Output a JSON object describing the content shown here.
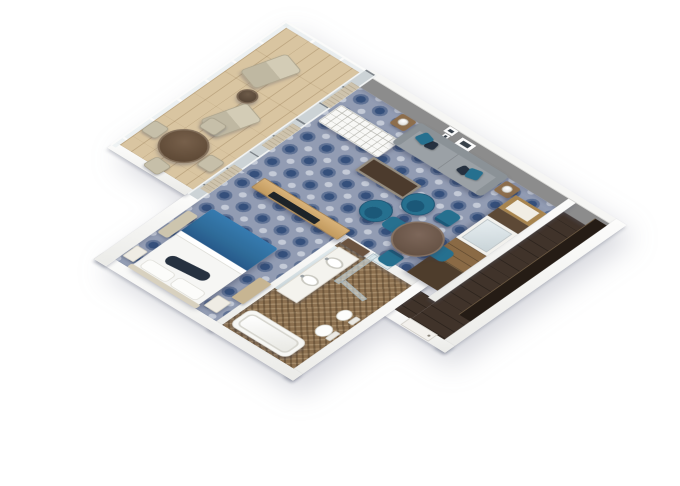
{
  "scene": {
    "type": "3d-floorplan-render",
    "view": "isometric-top-down",
    "colors": {
      "background": "#ffffff",
      "carpet_base": "#929cb3",
      "carpet_motif": "#35507c",
      "balcony_wood": "#d9c5a1",
      "wall_gray": "#8c8c8c",
      "wall_white": "#f6f6f4",
      "accent_teal": "#26708f",
      "accent_teal_dark": "#1b5878",
      "accent_navy": "#263140",
      "bed_blue": "#2e6b99",
      "tile_brown": "#8d7150",
      "corridor_wood": "#40332a",
      "corridor_dark": "#251c15",
      "sofa_gray": "#9ba1a6",
      "glass": "#ccd3d6",
      "curtain": "#cfc3ab"
    },
    "rooms": [
      {
        "name": "balcony",
        "floor": "wood-planks",
        "furniture": [
          "lounger",
          "lounger",
          "side-table",
          "round-table",
          "chair",
          "chair",
          "chair",
          "chair"
        ],
        "features": [
          "glass-railing",
          "divider-wall"
        ]
      },
      {
        "name": "living-room",
        "floor": "blue-pattern-carpet",
        "furniture": [
          "sofa",
          "teal-pillows",
          "side-table-with-lamp",
          "side-table-with-lamp",
          "white-tufted-bench",
          "coffee-table",
          "swivel-chair",
          "swivel-chair",
          "dining-table",
          "dining-chair",
          "dining-chair",
          "dining-chair",
          "dining-chair",
          "media-wall-unit-with-mirror"
        ],
        "features": [
          "gray-feature-wall",
          "wall-art-frames",
          "sliding-glass-doors",
          "curtains"
        ]
      },
      {
        "name": "bedroom",
        "floor": "blue-pattern-carpet",
        "furniture": [
          "bed-white-duvet-blue-runner",
          "nightstand",
          "nightstand",
          "bench",
          "tv-partition"
        ],
        "features": [
          "sliding-glass-doors"
        ]
      },
      {
        "name": "bathroom",
        "floor": "brown-mosaic-tile",
        "furniture": [
          "double-vanity",
          "sink",
          "sink",
          "mirror",
          "bathtub",
          "toilet",
          "bidet",
          "shower-glass",
          "towel-shelf"
        ],
        "features": []
      },
      {
        "name": "entry-corridor",
        "floor": "dark-wood",
        "furniture": [
          "closet-run",
          "entry-door"
        ],
        "features": []
      }
    ]
  }
}
